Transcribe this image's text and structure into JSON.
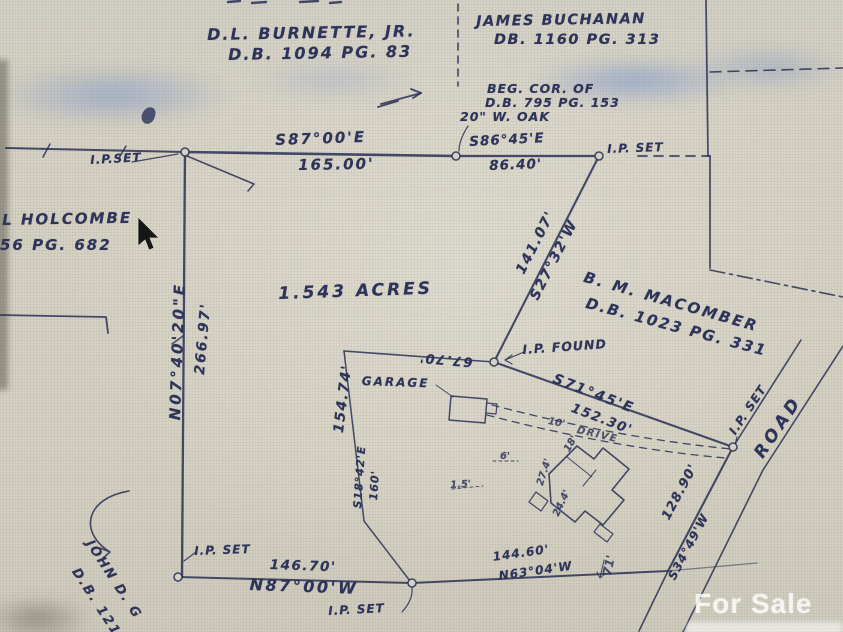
{
  "adjoiners": {
    "burnette": {
      "name": "D.L. BURNETTE, JR.",
      "deed": "D.B. 1094 PG. 83"
    },
    "buchanan": {
      "name": "JAMES BUCHANAN",
      "deed": "DB. 1160 PG. 313"
    },
    "holcombe": {
      "name": "L HOLCOMBE",
      "deed": "56 PG. 682"
    },
    "macomber": {
      "name": "B. M. MACOMBER",
      "deed": "D.B. 1023 PG. 331"
    },
    "john": {
      "name": "JOHN D. G",
      "deed": "D.B. 1219"
    }
  },
  "subject": {
    "area": "1.543 ACRES",
    "beg_cor_note": {
      "line1": "BEG. COR. OF",
      "line2": "D.B. 795 PG. 153",
      "line3": "20\" W. OAK"
    }
  },
  "courses": {
    "north1": {
      "bearing": "S87°00'E",
      "distance": "165.00'"
    },
    "north2": {
      "bearing": "S86°45'E",
      "distance": "86.40'"
    },
    "east": {
      "bearing": "S27°32'W",
      "distance": "141.07'"
    },
    "west": {
      "bearing": "N07°40'20\"E",
      "distance": "266.97'"
    },
    "southeast": {
      "bearing": "S71°45'E",
      "distance": "152.30'"
    },
    "road_front": {
      "bearing": "S34°49'W",
      "distance": "128.90'"
    },
    "south_a": {
      "bearing": "N87°00'W",
      "distance": "146.70'"
    },
    "south_b": {
      "bearing": "N63°04'W",
      "distance": "144.60'"
    },
    "interior": {
      "bearing": "S18°42'E",
      "distance": "160'"
    },
    "interior_west": {
      "distance": "154.74'"
    },
    "interior_north": {
      "distance": "67.70'"
    }
  },
  "monuments": {
    "ip_set_nw": "I.P.SET",
    "ip_set_ne": "I.P. SET",
    "ip_set_road": "I.P. SET",
    "ip_set_sw": "I.P. SET",
    "ip_set_south": "I.P. SET",
    "ip_found": "I.P. FOUND"
  },
  "features": {
    "road": "ROAD",
    "garage": "GARAGE",
    "drive": "DRIVE",
    "drive_width": "10'",
    "dims": {
      "d_18": "18'",
      "d_27_4": "27.4'",
      "d_24_4": "24.4'",
      "d_6": "6'",
      "d_1_5": "1.5'",
      "tie": "71'"
    }
  },
  "watermark": {
    "text": "For Sale"
  },
  "colors": {
    "ink": "#2e3459",
    "paper": "#d5d1c3",
    "watermark_text": "#faf9f6"
  }
}
